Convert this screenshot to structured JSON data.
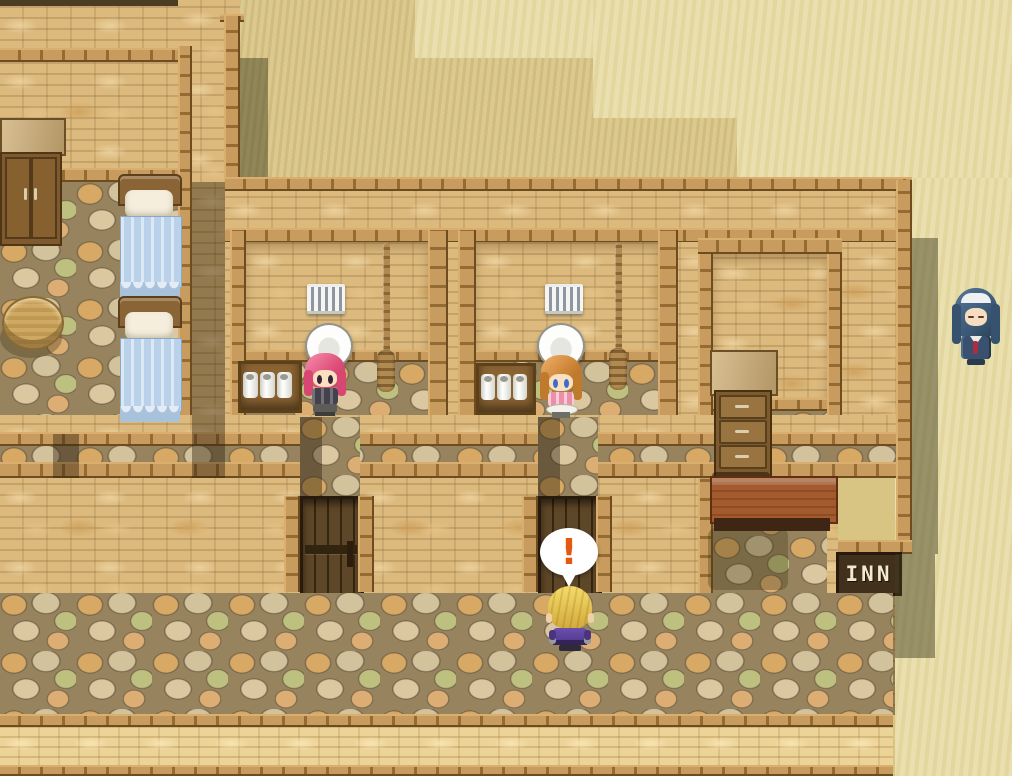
{
  "game": {
    "viewport": "desert inn exterior with open toilet stalls and bedroom",
    "sign_text": "INN",
    "alert_bubble": "!",
    "characters": [
      {
        "id": "pink-hair-girl",
        "desc": "pink-haired girl seated on toilet, left stall",
        "hair_color": "#e0517c"
      },
      {
        "id": "orange-hair-girl",
        "desc": "orange-haired girl seated on toilet, right stall",
        "hair_color": "#cc8435"
      },
      {
        "id": "blonde-hero",
        "desc": "blonde hero seen from behind, facing door, surprised",
        "hair_color": "#e6c44c",
        "outfit_color": "#5a4094"
      },
      {
        "id": "blue-hair-npc",
        "desc": "blue-haired priestess with white headband standing on sand",
        "hair_color": "#3c5a78",
        "tie_color": "#aa2e40"
      }
    ],
    "props": [
      "wardrobe",
      "two-beds",
      "round-table",
      "barred-window",
      "hanging-rope",
      "toilet",
      "toilet-paper-shelf",
      "chest-of-drawers",
      "reception-desk",
      "wooden-door",
      "inn-sign"
    ],
    "colors": {
      "sand": "#d7c383",
      "sand_light": "#e7dba4",
      "brick": "#dcba7e",
      "beam_wood": "#b5884a",
      "door_wood": "#4e3a20",
      "blanket_blue": "#b9d2ea",
      "alert_orange": "#e2590f",
      "sign_board": "#41301c",
      "sign_text_color": "#f3e9ce"
    }
  }
}
